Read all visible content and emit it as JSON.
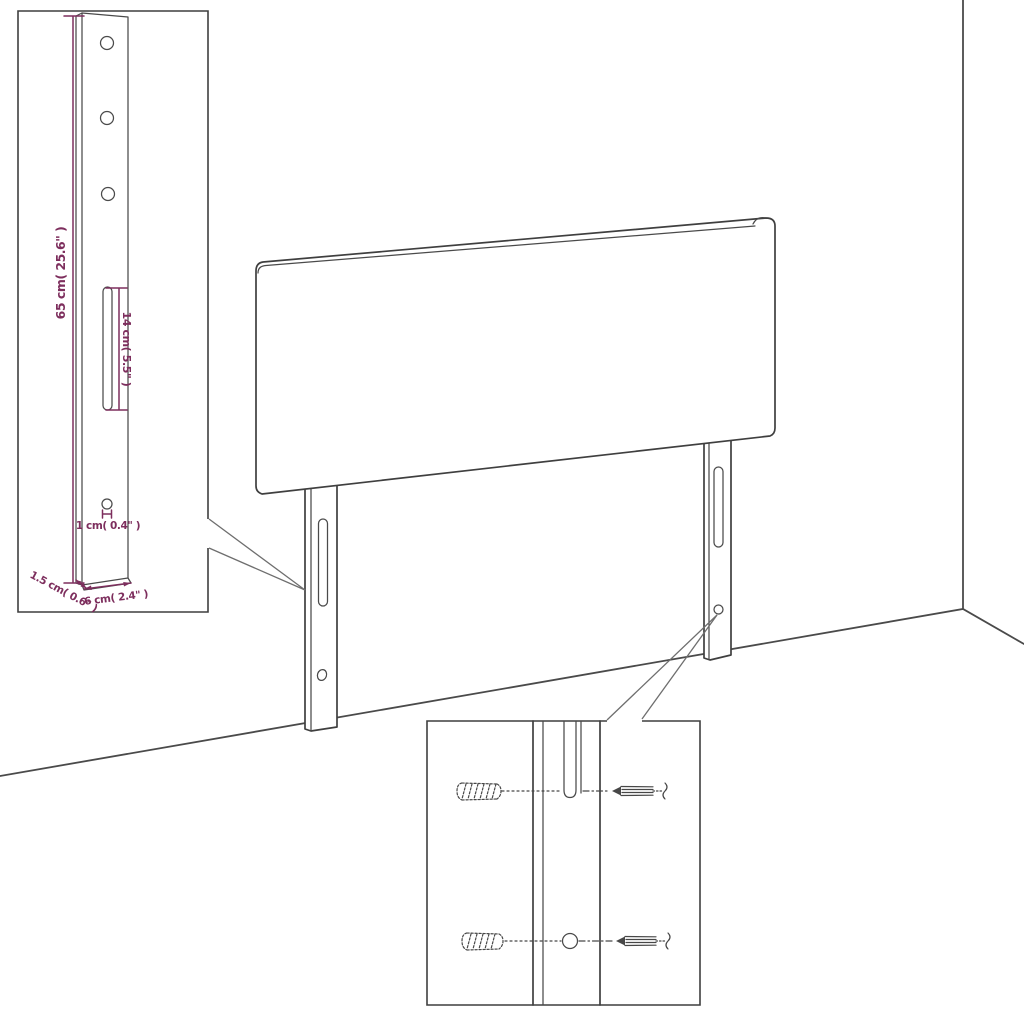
{
  "diagram": {
    "title": "headboard-dimension-diagram",
    "colors": {
      "background": "#ffffff",
      "drawing_line": "#3f3f3f",
      "dimension_accent": "#7d2e5d"
    },
    "inset_bracket": {
      "height_label": "65 cm( 25.6\" )",
      "slot_label": "14 cm( 5.5\" )",
      "hole_label": "1 cm( 0.4\" )",
      "thickness_label": "1.5 cm( 0.6\" )",
      "width_label": "6 cm( 2.4\" )"
    }
  }
}
